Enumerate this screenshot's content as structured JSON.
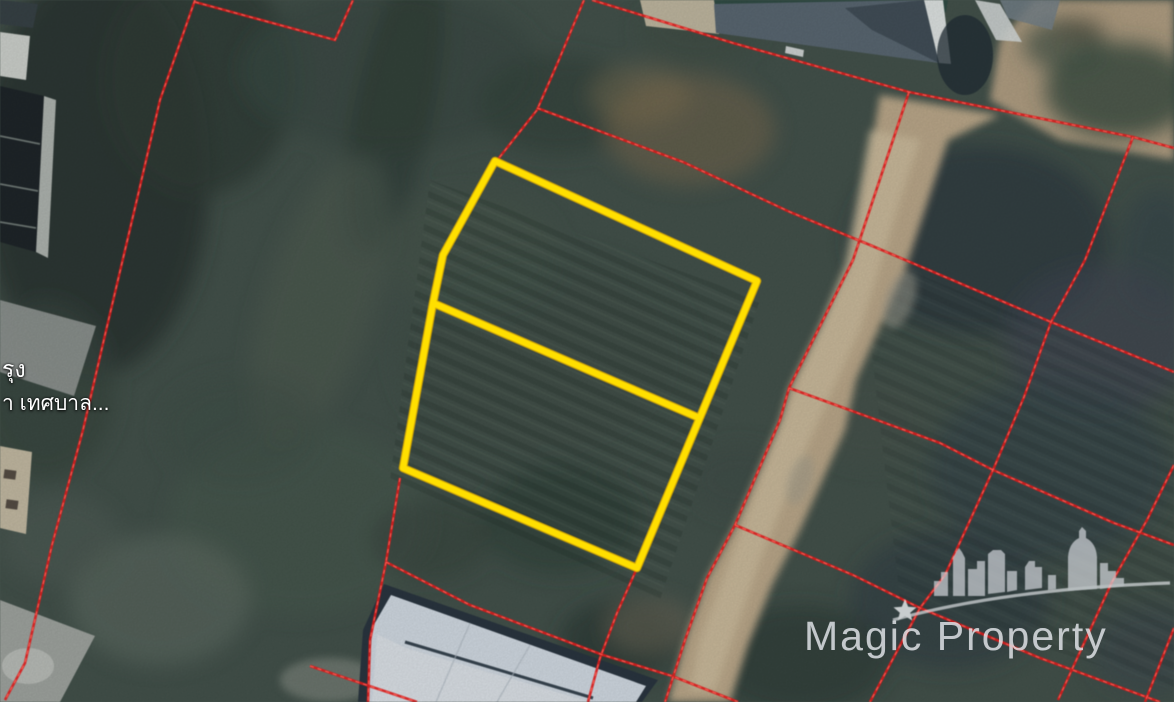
{
  "map": {
    "labels": {
      "place_line1": "รุง",
      "place_line2": "า เทศบาล..."
    }
  },
  "watermark": {
    "text": "Magic Property"
  },
  "overlay": {
    "parcel_lines_color": "#d41c1c",
    "parcel_lines_dash_color": "#ff6a5e",
    "highlight_color": "#ffdf00"
  }
}
